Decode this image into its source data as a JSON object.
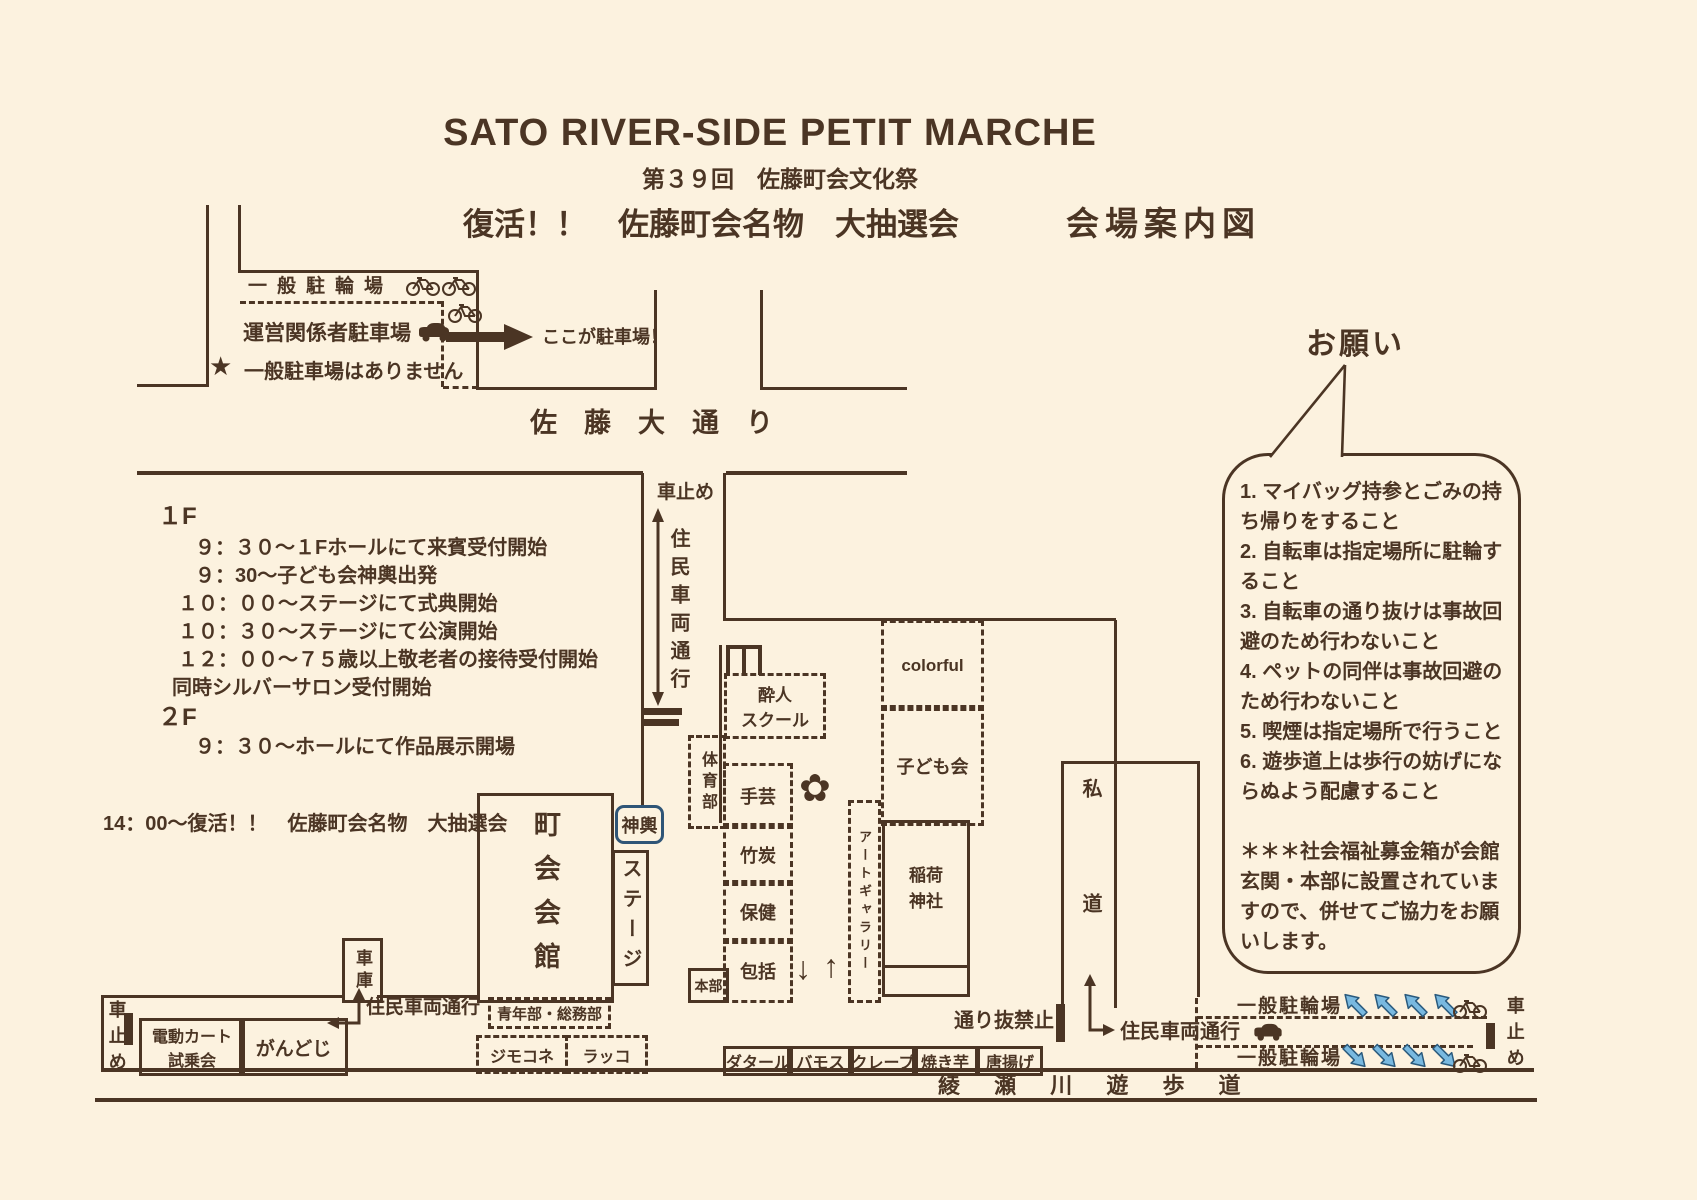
{
  "colors": {
    "ink": "#4b3524",
    "paper": "#fcf2df",
    "arrow_blue": "#79b9e0",
    "mikoshi_border": "#2f5577"
  },
  "header": {
    "title": "SATO RIVER-SIDE PETIT MARCHE",
    "subtitle": "第３９回　佐藤町会文化祭",
    "revival": "復活！！　佐藤町会名物　大抽選会",
    "map_title": "会場案内図"
  },
  "parking": {
    "bike_lot": "一般駐輪場",
    "staff_lot": "運営関係者駐車場",
    "here": "ここが駐車場！",
    "star": "★",
    "no_parking": "一般駐車場はありません"
  },
  "schedule": {
    "f1": "１F",
    "f2": "２F",
    "f1_lines": [
      "９：３０～１Fホールにて来賓受付開始",
      "９：30～子ども会神輿出発",
      "１０：００～ステージにて式典開始",
      "１０：３０～ステージにて公演開始",
      "１２：００～７５歳以上敬老者の接待受付開始",
      "同時シルバーサロン受付開始"
    ],
    "f2_lines": [
      "９：３０～ホールにて作品展示開場"
    ],
    "raffle": "14：00～復活！！　佐藤町会名物　大抽選会"
  },
  "streets": {
    "main": "佐　藤　大　通　り",
    "promenade": "綾 瀬 川 遊 歩 道"
  },
  "roads": {
    "car_stop": "車止め",
    "resident": "住民車両通行",
    "no_through": "通り抜禁止",
    "private_road": "私道",
    "bike_lot": "一般駐輪場"
  },
  "map": {
    "hall": "町会会館",
    "stage": "ステージ",
    "mikoshi": "神輿",
    "garage": "車庫",
    "hq": "本部",
    "shrine": [
      "稲荷",
      "神社"
    ],
    "suijin": [
      "酔人",
      "スクール"
    ],
    "taiiku": "体育部",
    "shugei": "手芸",
    "takesumi": "竹炭",
    "hoken": "保健",
    "houkatsu": "包括",
    "colorful": "colorful",
    "kodomo": "子ども会",
    "gallery": "アートギャラリー",
    "seinen": "青年部・総務部",
    "jimokone": "ジモコネ",
    "rakko": "ラッコ",
    "gandoji": "がんどじ",
    "cart": [
      "電動カート",
      "試乗会"
    ],
    "stalls": [
      "ダタール",
      "バモス",
      "クレープ",
      "焼き芋",
      "唐揚げ"
    ],
    "plaza_down_arrow": "↓",
    "plaza_up_arrow": "↑"
  },
  "bubble": {
    "title": "お願い",
    "lines": [
      "1. マイバッグ持参とごみの持",
      "ち帰りをすること",
      "2. 自転車は指定場所に駐輪す",
      "ること",
      "3. 自転車の通り抜けは事故回",
      "避のため行わないこと",
      "4. ペットの同伴は事故回避の",
      "ため行わないこと",
      "5. 喫煙は指定場所で行うこと",
      "6. 遊歩道上は歩行の妨げにな",
      "らぬよう配慮すること",
      "",
      "＊＊＊社会福祉募金箱が会館",
      "玄関・本部に設置されていま",
      "すので、併せてご協力をお願",
      "いします。"
    ]
  }
}
